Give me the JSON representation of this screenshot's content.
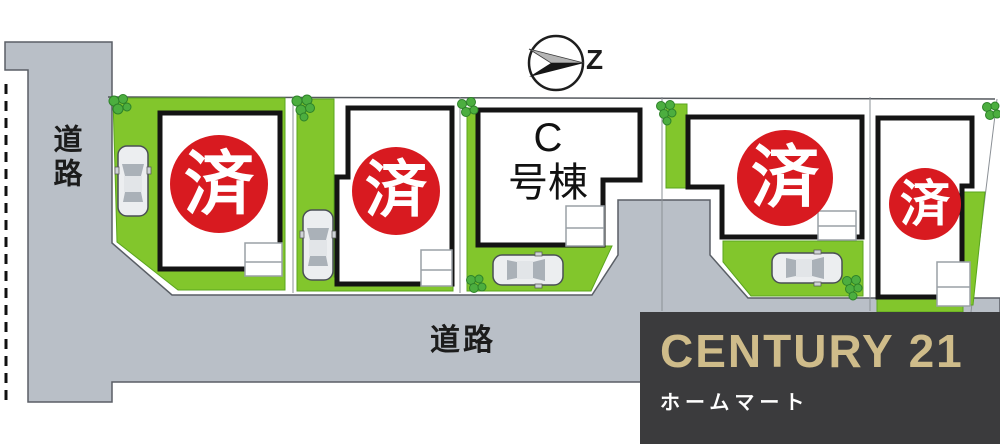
{
  "plan": {
    "compass": {
      "direction_label": "Z"
    },
    "roads": {
      "left_label": "道路",
      "bottom_label": "道路"
    },
    "lots": [
      {
        "position": 1,
        "status": "済"
      },
      {
        "position": 2,
        "status": "済"
      },
      {
        "position": 3,
        "name": "C号棟",
        "name_line1": "C",
        "name_line2": "号棟"
      },
      {
        "position": 4,
        "status": "済"
      },
      {
        "position": 5,
        "status": "済"
      }
    ],
    "colors": {
      "sold_badge": "#d81a20",
      "grass": "#82c62c",
      "road": "#b9bfc7"
    }
  },
  "logo": {
    "brand": "CENTURY 21",
    "company": "ホームマート",
    "colors": {
      "background": "#3b3b3d",
      "brand_text": "#cfbc8a",
      "company_text": "#ffffff"
    }
  }
}
